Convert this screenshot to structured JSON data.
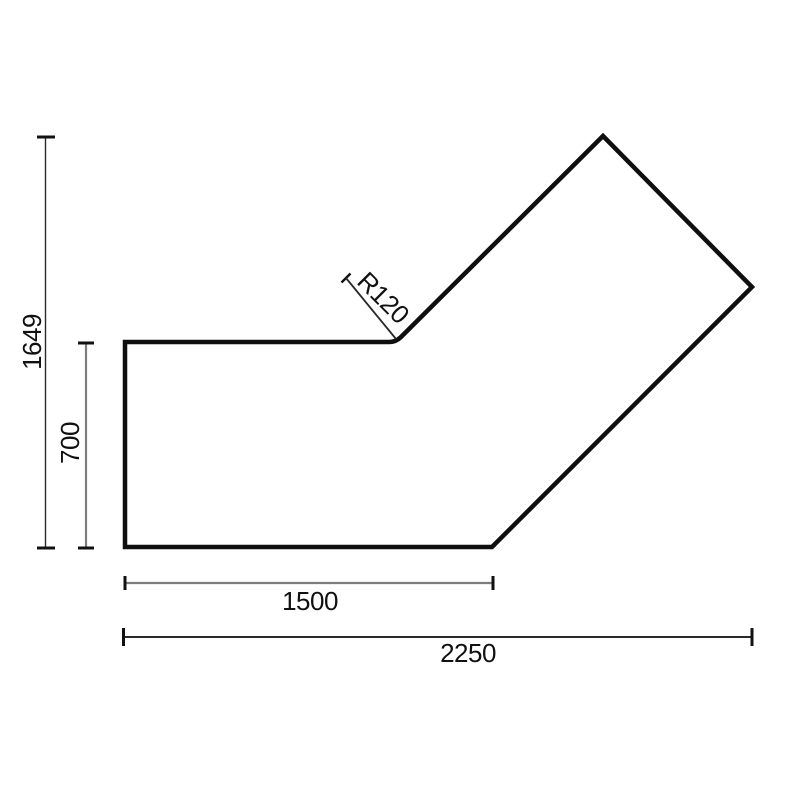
{
  "drawing": {
    "background": "#ffffff",
    "colors": {
      "outline": "#0f0f0f",
      "dim_line_gray": "#7d7d7d",
      "dim_line_dark": "#2a2a2a",
      "tick": "#111111",
      "text": "#111111"
    },
    "dimensions": {
      "total_height": "1649",
      "left_depth": "700",
      "bottom_width": "1500",
      "total_width": "2250",
      "corner_radius": "R120"
    }
  }
}
